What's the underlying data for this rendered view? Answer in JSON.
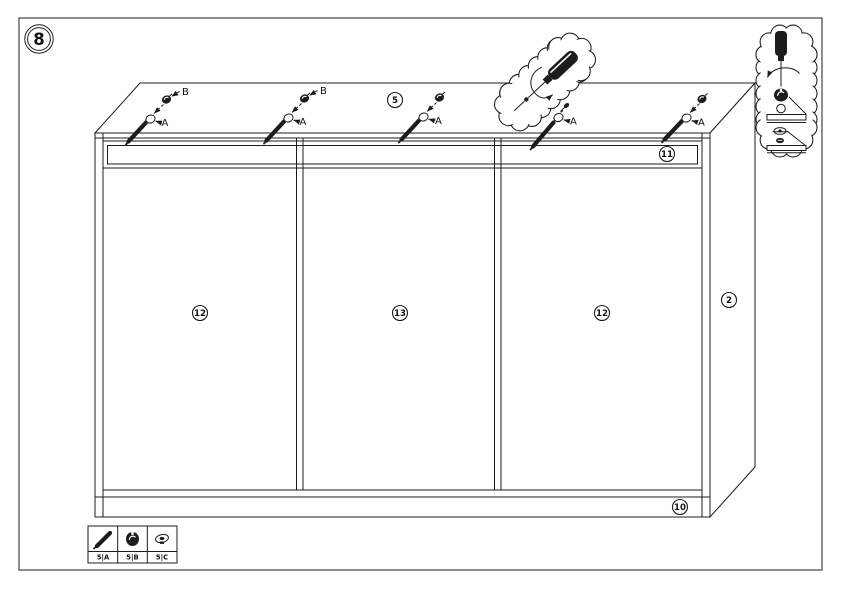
{
  "step": {
    "number": "8"
  },
  "colors": {
    "line": "#1c1c1c",
    "background": "#ffffff"
  },
  "parts": {
    "top_panel": {
      "label": "5"
    },
    "top_rail": {
      "label": "11"
    },
    "left_door": {
      "label": "12"
    },
    "middle_door": {
      "label": "13"
    },
    "right_door": {
      "label": "12"
    },
    "side_panel": {
      "label": "2"
    },
    "bottom_rail": {
      "label": "10"
    }
  },
  "callouts": [
    {
      "fastener_icon": "screw-icon",
      "fitting_icon": "cam-lock-icon",
      "hole_label": "A",
      "fitting_label": "B"
    },
    {
      "fastener_icon": "screw-icon",
      "fitting_icon": "cam-lock-icon",
      "hole_label": "A",
      "fitting_label": "B"
    },
    {
      "fastener_icon": "screw-icon",
      "fitting_icon": "cam-lock-icon",
      "hole_label": "A"
    },
    {
      "fastener_icon": "screw-icon",
      "fitting_icon": "cam-screw-icon",
      "hole_label": "A"
    },
    {
      "fastener_icon": "screw-icon",
      "fitting_icon": "cam-lock-icon",
      "hole_label": "A"
    }
  ],
  "detail_bubbles": {
    "top": {
      "icons": [
        "screwdriver-icon",
        "rotation-arrow-icon"
      ]
    },
    "right": {
      "icons": [
        "screwdriver-icon",
        "rotation-arrow-icon",
        "cam-lock-icon",
        "pilot-hole-icon",
        "panel-edge",
        "cam-screw-icon",
        "screw-head-icon",
        "panel-edge"
      ]
    }
  },
  "legend": {
    "items": [
      {
        "icon": "screw-icon",
        "code": "5|A"
      },
      {
        "icon": "cam-lock-icon",
        "code": "5|B"
      },
      {
        "icon": "cam-screw-icon",
        "code": "5|C"
      }
    ]
  }
}
